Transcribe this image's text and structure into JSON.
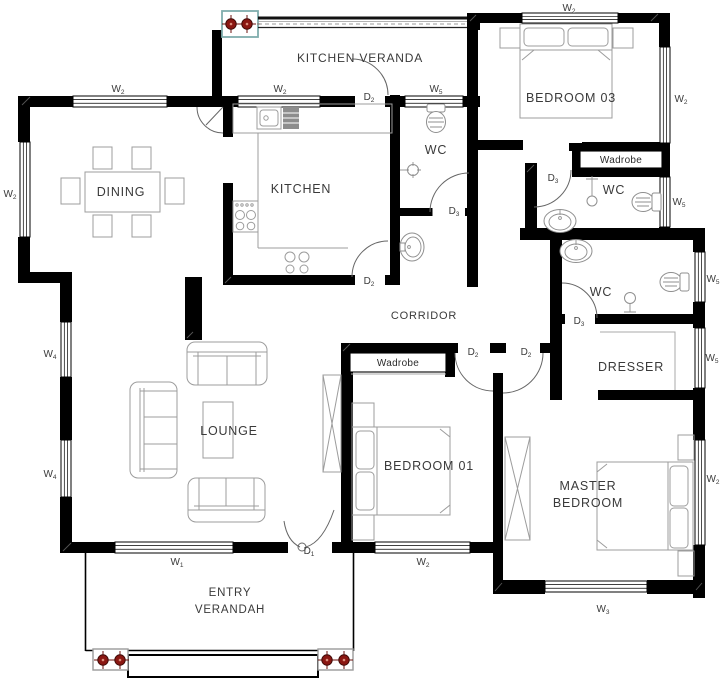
{
  "colors": {
    "wall": "#000000",
    "furniture": "#9c9c9c",
    "door": "#666666",
    "text": "#3a3a3a",
    "column_marker": "#8b1712",
    "column_box_entry": "#9a9a9a",
    "column_box_veranda": "#7fadad"
  },
  "rooms": [
    {
      "id": "kitchen-veranda",
      "lines": [
        "KITCHEN VERANDA"
      ],
      "x": 360,
      "y": 62,
      "fs": 12
    },
    {
      "id": "dining",
      "lines": [
        "DINING"
      ],
      "x": 121,
      "y": 196,
      "fs": 12.5
    },
    {
      "id": "kitchen",
      "lines": [
        "KITCHEN"
      ],
      "x": 301,
      "y": 193,
      "fs": 12.5
    },
    {
      "id": "wc-corridor",
      "lines": [
        "WC"
      ],
      "x": 436,
      "y": 154,
      "fs": 12.5
    },
    {
      "id": "bedroom-03",
      "lines": [
        "BEDROOM 03"
      ],
      "x": 571,
      "y": 102,
      "fs": 12.5
    },
    {
      "id": "wc-bedroom03",
      "lines": [
        "WC"
      ],
      "x": 614,
      "y": 194,
      "fs": 12.5
    },
    {
      "id": "wc-master",
      "lines": [
        "WC"
      ],
      "x": 601,
      "y": 296,
      "fs": 12.5
    },
    {
      "id": "corridor",
      "lines": [
        "CORRIDOR"
      ],
      "x": 424,
      "y": 319,
      "fs": 11
    },
    {
      "id": "dresser",
      "lines": [
        "DRESSER"
      ],
      "x": 631,
      "y": 371,
      "fs": 12.5
    },
    {
      "id": "lounge",
      "lines": [
        "LOUNGE"
      ],
      "x": 229,
      "y": 435,
      "fs": 12.5
    },
    {
      "id": "bedroom-01",
      "lines": [
        "BEDROOM 01"
      ],
      "x": 429,
      "y": 470,
      "fs": 12.5
    },
    {
      "id": "master-bedroom",
      "lines": [
        "MASTER",
        "BEDROOM"
      ],
      "x": 588,
      "y": 490,
      "fs": 12.5
    },
    {
      "id": "entry-verandah",
      "lines": [
        "ENTRY",
        "VERANDAH"
      ],
      "x": 230,
      "y": 596,
      "fs": 11.5
    },
    {
      "id": "wardrobe-bedroom03",
      "lines": [
        "Wadrobe"
      ],
      "x": 621,
      "y": 163,
      "fs": 10,
      "cls": "wadrobe"
    },
    {
      "id": "wardrobe-bedroom01",
      "lines": [
        "Wadrobe"
      ],
      "x": 398,
      "y": 366,
      "fs": 10,
      "cls": "wadrobe"
    }
  ],
  "window_labels": [
    {
      "base": "W",
      "sub": "2",
      "x": 118,
      "y": 92
    },
    {
      "base": "W",
      "sub": "2",
      "x": 280,
      "y": 92
    },
    {
      "base": "W",
      "sub": "5",
      "x": 436,
      "y": 92
    },
    {
      "base": "W",
      "sub": "2",
      "x": 10,
      "y": 197
    },
    {
      "base": "W",
      "sub": "4",
      "x": 50,
      "y": 357
    },
    {
      "base": "W",
      "sub": "4",
      "x": 50,
      "y": 477
    },
    {
      "base": "W",
      "sub": "1",
      "x": 177,
      "y": 565
    },
    {
      "base": "W",
      "sub": "2",
      "x": 423,
      "y": 565
    },
    {
      "base": "W",
      "sub": "3",
      "x": 603,
      "y": 612
    },
    {
      "base": "W",
      "sub": "2",
      "x": 569,
      "y": 11
    },
    {
      "base": "W",
      "sub": "2",
      "x": 681,
      "y": 102
    },
    {
      "base": "W",
      "sub": "5",
      "x": 679,
      "y": 205
    },
    {
      "base": "W",
      "sub": "5",
      "x": 713,
      "y": 282
    },
    {
      "base": "W",
      "sub": "5",
      "x": 712,
      "y": 361
    },
    {
      "base": "W",
      "sub": "2",
      "x": 713,
      "y": 482
    }
  ],
  "door_labels": [
    {
      "base": "D",
      "sub": "1",
      "x": 309,
      "y": 554
    },
    {
      "base": "D",
      "sub": "2",
      "x": 369,
      "y": 100
    },
    {
      "base": "D",
      "sub": "2",
      "x": 369,
      "y": 284
    },
    {
      "base": "D",
      "sub": "2",
      "x": 473,
      "y": 355
    },
    {
      "base": "D",
      "sub": "2",
      "x": 526,
      "y": 355
    },
    {
      "base": "D",
      "sub": "3",
      "x": 454,
      "y": 214
    },
    {
      "base": "D",
      "sub": "3",
      "x": 553,
      "y": 181
    },
    {
      "base": "D",
      "sub": "3",
      "x": 579,
      "y": 324
    }
  ]
}
